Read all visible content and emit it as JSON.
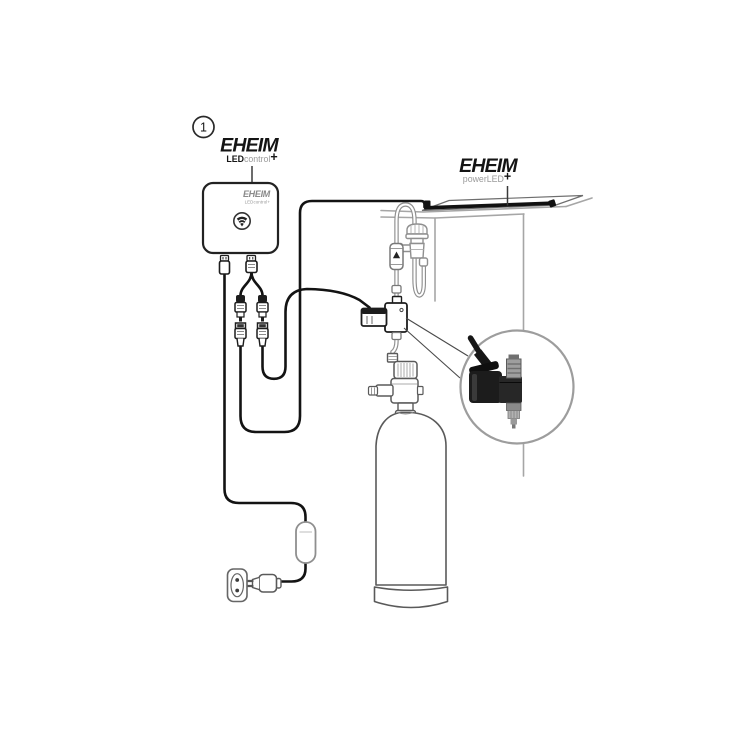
{
  "diagram": {
    "step_badge": "1",
    "controller_label": {
      "brand": "EHEIM",
      "bold": "LED",
      "light": "control",
      "plus": "+"
    },
    "controller_print": {
      "brand": "EHEIM",
      "model": "LEDcontrol+"
    },
    "light_label": {
      "brand": "EHEIM",
      "light": "powerLED",
      "plus": "+"
    }
  },
  "colors": {
    "ink": "#1a1a1a",
    "tank_gray": "#a6a6a6",
    "tube_gray": "#8f8f8f"
  }
}
